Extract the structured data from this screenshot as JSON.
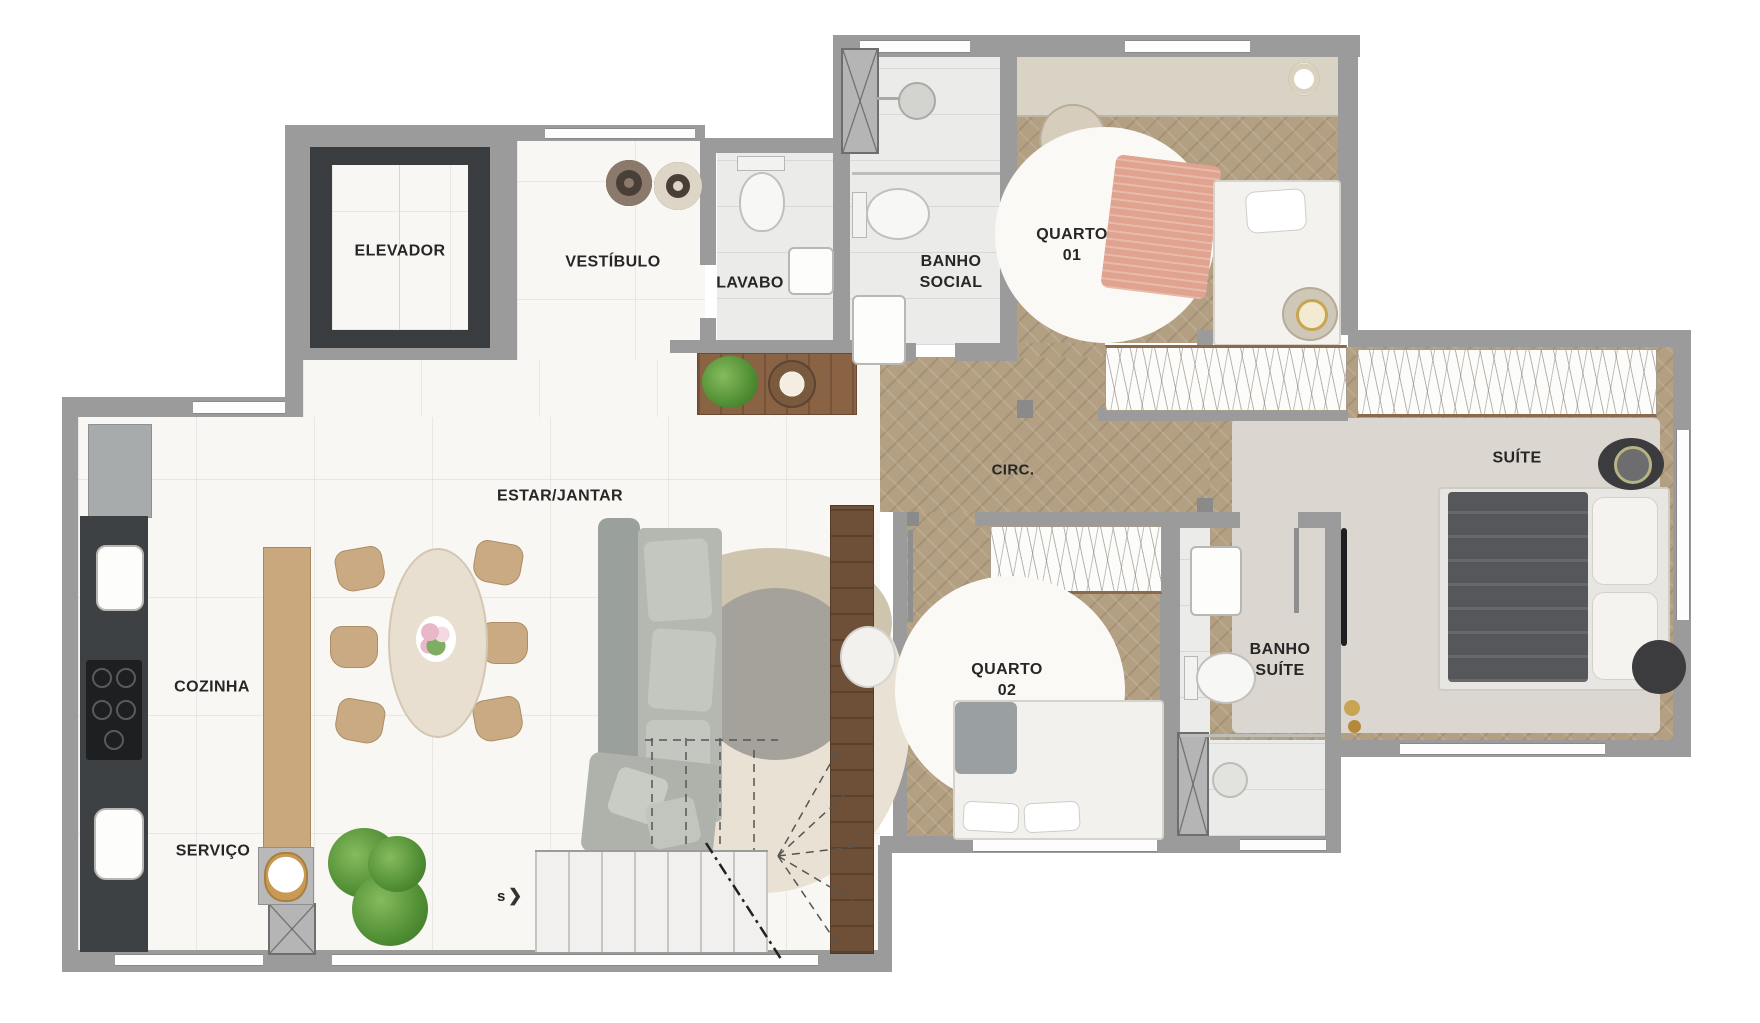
{
  "plan": {
    "type": "apartment-floor-plan",
    "rooms": [
      {
        "id": "elevador",
        "label": "ELEVADOR"
      },
      {
        "id": "vestibulo",
        "label": "VESTÍBULO"
      },
      {
        "id": "lavabo",
        "label": "LAVABO"
      },
      {
        "id": "banho-social",
        "label": "BANHO\nSOCIAL"
      },
      {
        "id": "quarto-01",
        "label": "QUARTO\n01"
      },
      {
        "id": "circ",
        "label": "CIRC."
      },
      {
        "id": "suite",
        "label": "SUÍTE"
      },
      {
        "id": "estar-jantar",
        "label": "ESTAR/JANTAR"
      },
      {
        "id": "cozinha",
        "label": "COZINHA"
      },
      {
        "id": "quarto-02",
        "label": "QUARTO\n02"
      },
      {
        "id": "banho-suite",
        "label": "BANHO\nSUÍTE"
      },
      {
        "id": "servico",
        "label": "SERVIÇO"
      }
    ],
    "stairs": {
      "marker": "s",
      "arrow": "❯"
    },
    "palette": {
      "wall_gray": "#9B9B9B",
      "elevator_shaft": "#3A3D40",
      "wood_floor": "#B3A083",
      "marble_floor": "#F8F7F4",
      "kitchen_counter": "#3E4144",
      "greenery": "#4F8D33"
    }
  }
}
